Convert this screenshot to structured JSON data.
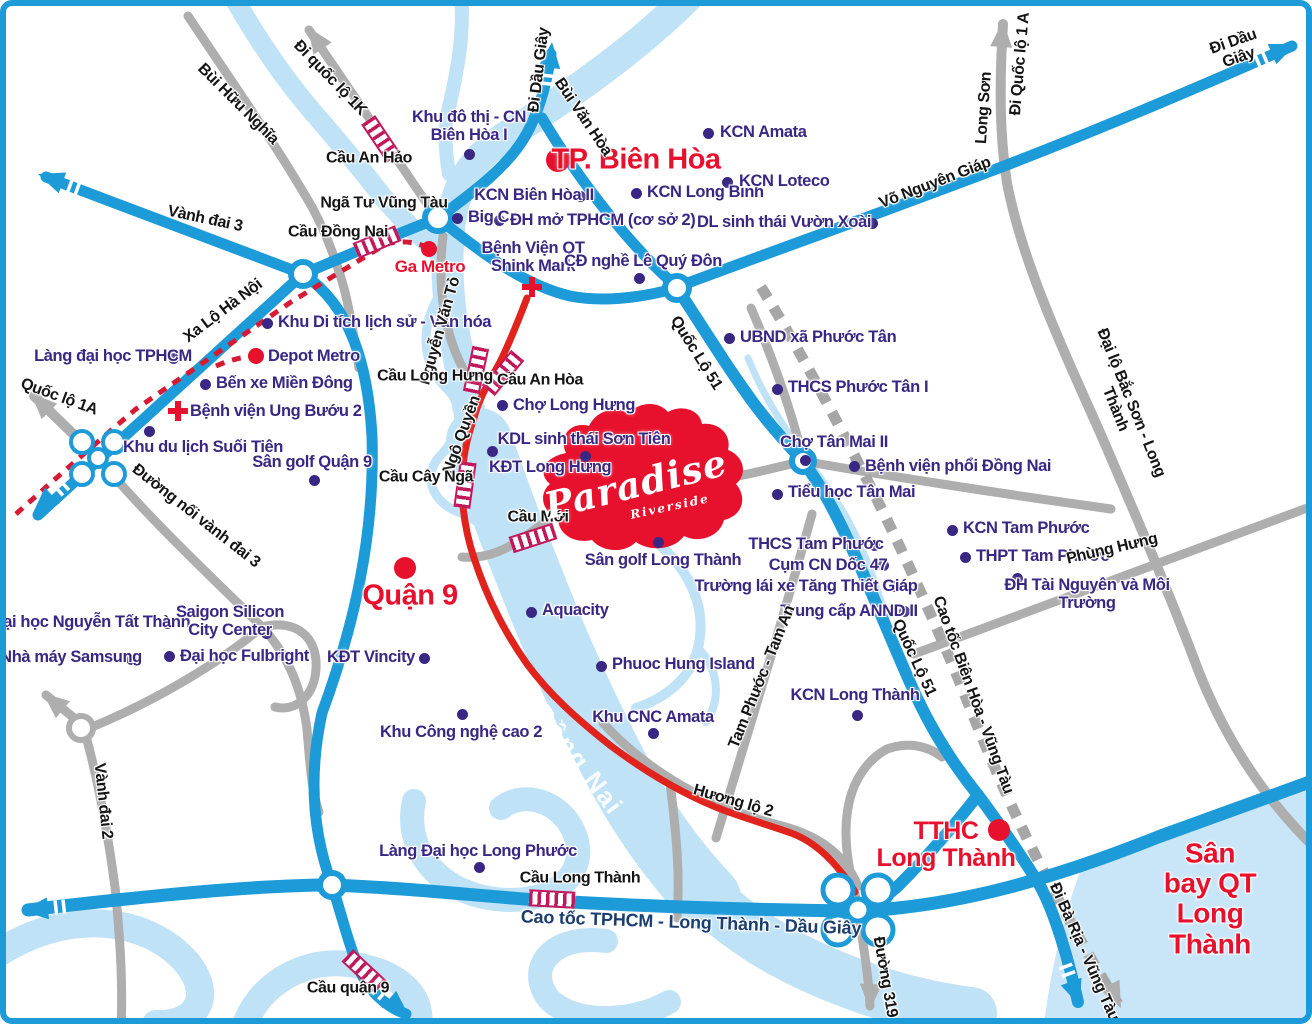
{
  "map_title": "Paradise Riverside area map (Biên Hòa - Long Thành)",
  "colors": {
    "road_blue": "#1C9BD8",
    "road_gray": "#AEAEAE",
    "road_red": "#E0231D",
    "river": "#BFE2F7",
    "airport_fill": "#C9E5F8",
    "poi_purple": "#3A2783",
    "label_red": "#E8112D",
    "bridge": "#C2185B",
    "metro_dash_red": "#D61A33",
    "expressway_dash_gray": "#A6A6A6",
    "highway_label_navy": "#1B3E70"
  },
  "logo": {
    "name": "Paradise",
    "sub": "Riverside"
  },
  "labels": [
    {
      "id": "khu-do-thi-cn-bien-hoa-1",
      "text": "Khu đô thị - CN\nBiên Hòa I",
      "x": 463,
      "y": 121,
      "cls": "lb-poi"
    },
    {
      "id": "kcn-amata",
      "text": "KCN Amata",
      "x": 714,
      "y": 127,
      "cls": "lb-poi",
      "align": "left"
    },
    {
      "id": "kcn-bien-hoa-2",
      "text": "KCN Biên Hòa II",
      "x": 528,
      "y": 190,
      "cls": "lb-poi"
    },
    {
      "id": "kcn-long-binh",
      "text": "KCN Long Bình",
      "x": 641,
      "y": 187,
      "cls": "lb-poi",
      "align": "left"
    },
    {
      "id": "kcn-loteco",
      "text": "KCN Loteco",
      "x": 733,
      "y": 176,
      "cls": "lb-poi",
      "align": "left"
    },
    {
      "id": "big-c",
      "text": "Big C",
      "x": 462,
      "y": 212,
      "cls": "lb-poi",
      "align": "left"
    },
    {
      "id": "dh-mo-tphcm",
      "text": "ĐH mở TPHCM (cơ sở 2)",
      "x": 504,
      "y": 215,
      "cls": "lb-poi",
      "align": "left"
    },
    {
      "id": "dl-sinh-thai-vuon-xoai",
      "text": "DL sinh thái Vườn Xoài",
      "x": 778,
      "y": 217,
      "cls": "lb-poi"
    },
    {
      "id": "benh-vien-qt-shink-mark",
      "text": "Bệnh Viện QT\nShink Mark",
      "x": 527,
      "y": 252,
      "cls": "lb-poi"
    },
    {
      "id": "cd-nghe-le-quy-don",
      "text": "CĐ nghề Lê Quý Đôn",
      "x": 637,
      "y": 256,
      "cls": "lb-poi"
    },
    {
      "id": "khu-di-tich-lich-su",
      "text": "Khu Di tích lịch sử - Văn hóa",
      "x": 272,
      "y": 317,
      "cls": "lb-poi",
      "align": "left"
    },
    {
      "id": "lang-dai-hoc-tphcm",
      "text": "Làng đại học TPHCM",
      "x": 107,
      "y": 351,
      "cls": "lb-poi"
    },
    {
      "id": "depot-metro",
      "text": "Depot Metro",
      "x": 262,
      "y": 351,
      "cls": "lb-poi",
      "align": "left"
    },
    {
      "id": "ben-xe-mien-dong",
      "text": "Bến xe Miền Đông",
      "x": 210,
      "y": 378,
      "cls": "lb-poi",
      "align": "left"
    },
    {
      "id": "benh-vien-ung-buou-2",
      "text": "Bệnh viện Ung Bướu 2",
      "x": 184,
      "y": 406,
      "cls": "lb-poi",
      "align": "left"
    },
    {
      "id": "khu-du-lich-suoi-tien",
      "text": "Khu du lịch Suối Tiên",
      "x": 197,
      "y": 442,
      "cls": "lb-poi"
    },
    {
      "id": "san-golf-quan-9",
      "text": "Sân golf Quận 9",
      "x": 306,
      "y": 457,
      "cls": "lb-poi"
    },
    {
      "id": "ubnd-xa-phuoc-tan",
      "text": "UBND xã Phước Tân",
      "x": 734,
      "y": 332,
      "cls": "lb-poi",
      "align": "left"
    },
    {
      "id": "thcs-phuoc-tan-1",
      "text": "THCS Phước Tân I",
      "x": 782,
      "y": 382,
      "cls": "lb-poi",
      "align": "left"
    },
    {
      "id": "cho-tan-mai-2",
      "text": "Chợ Tân Mai II",
      "x": 828,
      "y": 437,
      "cls": "lb-poi"
    },
    {
      "id": "benh-vien-phoi-dong-nai",
      "text": "Bệnh viện phổi Đồng Nai",
      "x": 859,
      "y": 461,
      "cls": "lb-poi",
      "align": "left"
    },
    {
      "id": "tieu-hoc-tan-mai",
      "text": "Tiểu học Tân Mai",
      "x": 782,
      "y": 487,
      "cls": "lb-poi",
      "align": "left"
    },
    {
      "id": "kcn-tam-phuoc",
      "text": "KCN Tam Phước",
      "x": 957,
      "y": 523,
      "cls": "lb-poi",
      "align": "left"
    },
    {
      "id": "thpt-tam-phuoc",
      "text": "THPT Tam Phước",
      "x": 970,
      "y": 551,
      "cls": "lb-poi",
      "align": "left"
    },
    {
      "id": "dh-tai-nguyen-moi-truong",
      "text": "ĐH Tài Nguyên và Môi Trường",
      "x": 1081,
      "y": 589,
      "cls": "lb-poi"
    },
    {
      "id": "thcs-tam-phuoc",
      "text": "THCS Tam Phước",
      "x": 810,
      "y": 539,
      "cls": "lb-poi"
    },
    {
      "id": "cum-cn-doc-47",
      "text": "Cụm CN Dốc  47",
      "x": 822,
      "y": 560,
      "cls": "lb-poi"
    },
    {
      "id": "truong-lai-xe-tang-thiet-giap",
      "text": "Trường lái xe Tăng Thiết Giáp",
      "x": 800,
      "y": 581,
      "cls": "lb-poi"
    },
    {
      "id": "trung-cap-annd-2",
      "text": "Trung cấp ANND II",
      "x": 843,
      "y": 606,
      "cls": "lb-poi"
    },
    {
      "id": "kcn-long-thanh",
      "text": "KCN Long Thành",
      "x": 849,
      "y": 690,
      "cls": "lb-poi"
    },
    {
      "id": "kdl-sinh-thai-son-tien",
      "text": "KDL sinh thái Sơn Tiên",
      "x": 578,
      "y": 434,
      "cls": "lb-poi"
    },
    {
      "id": "cho-long-hung",
      "text": "Chợ Long Hưng",
      "x": 507,
      "y": 400,
      "cls": "lb-poi",
      "align": "left"
    },
    {
      "id": "kdt-long-hung",
      "text": "KĐT Long Hưng",
      "x": 483,
      "y": 462,
      "cls": "lb-poi",
      "align": "left"
    },
    {
      "id": "san-golf-long-thanh",
      "text": "Sân golf Long Thành",
      "x": 657,
      "y": 555,
      "cls": "lb-poi"
    },
    {
      "id": "aquacity",
      "text": "Aquacity",
      "x": 536,
      "y": 605,
      "cls": "lb-poi",
      "align": "left"
    },
    {
      "id": "kdt-vincity",
      "text": "KĐT Vincity",
      "x": 365,
      "y": 652,
      "cls": "lb-poi"
    },
    {
      "id": "khu-cong-nghe-cao-2",
      "text": "Khu Công nghệ cao 2",
      "x": 455,
      "y": 727,
      "cls": "lb-poi"
    },
    {
      "id": "phuoc-hung-island",
      "text": "Phuoc Hung Island",
      "x": 606,
      "y": 659,
      "cls": "lb-poi",
      "align": "left"
    },
    {
      "id": "khu-cnc-amata",
      "text": "Khu CNC Amata",
      "x": 647,
      "y": 712,
      "cls": "lb-poi"
    },
    {
      "id": "dh-nguyen-tat-thanh",
      "text": "Đại học Nguyễn Tất Thành",
      "x": 85,
      "y": 617,
      "cls": "lb-poi"
    },
    {
      "id": "saigon-silicon-city-center",
      "text": "Saigon Silicon\nCity Center",
      "x": 224,
      "y": 616,
      "cls": "lb-poi"
    },
    {
      "id": "nha-may-samsung",
      "text": "Nhà máy Samsung",
      "x": 65,
      "y": 652,
      "cls": "lb-poi"
    },
    {
      "id": "dh-fulbright",
      "text": "Đại học Fulbright",
      "x": 174,
      "y": 651,
      "cls": "lb-poi",
      "align": "left"
    },
    {
      "id": "lang-dh-long-phuoc",
      "text": "Làng Đại học Long Phước",
      "x": 472,
      "y": 846,
      "cls": "lb-poi"
    },
    {
      "id": "tp-bien-hoa",
      "text": "TP. Biên Hòa",
      "x": 630,
      "y": 154,
      "cls": "lb-city"
    },
    {
      "id": "quan-9",
      "text": "Quận 9",
      "x": 404,
      "y": 590,
      "cls": "lb-city"
    },
    {
      "id": "tthc-long-thanh",
      "text": "TTHC\nLong Thành",
      "x": 940,
      "y": 839,
      "cls": "lb-city2"
    },
    {
      "id": "san-bay-qt-long-thanh",
      "text": "Sân bay QT\nLong Thành",
      "x": 1204,
      "y": 893,
      "cls": "lb-airport"
    },
    {
      "id": "ga-metro",
      "text": "Ga Metro",
      "x": 424,
      "y": 261,
      "cls": "lb-redsm"
    },
    {
      "id": "bui-huu-nghia",
      "text": "Bùi Hữu Nghĩa",
      "x": 232,
      "y": 98,
      "rot": 45,
      "cls": "lb-road"
    },
    {
      "id": "di-quoc-lo-1k",
      "text": "Đi quốc lộ 1K",
      "x": 324,
      "y": 72,
      "rot": 46,
      "cls": "lb-road"
    },
    {
      "id": "cau-an-hao",
      "text": "Cầu An Hảo",
      "x": 363,
      "y": 152,
      "cls": "lb-road"
    },
    {
      "id": "nga-tu-vung-tau",
      "text": "Ngã Tư Vũng Tàu",
      "x": 378,
      "y": 197,
      "cls": "lb-road"
    },
    {
      "id": "cau-dong-nai",
      "text": "Cầu Đồng Nai",
      "x": 332,
      "y": 226,
      "cls": "lb-road"
    },
    {
      "id": "vanh-dai-3",
      "text": "Vành đai 3",
      "x": 199,
      "y": 213,
      "rot": 12,
      "cls": "lb-road"
    },
    {
      "id": "xa-lo-ha-noi",
      "text": "Xa Lộ Hà Nội",
      "x": 217,
      "y": 305,
      "rot": -37,
      "cls": "lb-road"
    },
    {
      "id": "quoc-lo-1a",
      "text": "Quốc lộ 1A",
      "x": 53,
      "y": 391,
      "rot": 20,
      "cls": "lb-road"
    },
    {
      "id": "duong-noi-vanh-dai-3",
      "text": "Đường nối vành đai 3",
      "x": 190,
      "y": 510,
      "rot": 38,
      "cls": "lb-road"
    },
    {
      "id": "vanh-dai-2",
      "text": "Vành đai 2",
      "x": 97,
      "y": 795,
      "rot": 84,
      "cls": "lb-road"
    },
    {
      "id": "nguyen-van-to",
      "text": "Nguyễn Văn Tỏ",
      "x": 434,
      "y": 325,
      "rot": -74,
      "cls": "lb-road"
    },
    {
      "id": "ngo-quyen",
      "text": "Ngô Quyền",
      "x": 456,
      "y": 429,
      "rot": -70,
      "cls": "lb-road"
    },
    {
      "id": "bui-van-hoa",
      "text": "Bùi Văn Hòa",
      "x": 577,
      "y": 111,
      "rot": 56,
      "cls": "lb-road"
    },
    {
      "id": "vo-nguyen-giap",
      "text": "Võ Nguyên Giáp",
      "x": 929,
      "y": 177,
      "rot": -21,
      "cls": "lb-road"
    },
    {
      "id": "long-son",
      "text": "Long Sơn",
      "x": 978,
      "y": 102,
      "rot": -86,
      "cls": "lb-road"
    },
    {
      "id": "di-quoc-lo-1a",
      "text": "Đi Quốc lộ 1 A",
      "x": 1014,
      "y": 58,
      "rot": -85,
      "cls": "lb-road"
    },
    {
      "id": "di-dau-giay-right",
      "text": "Đi Dầu Giây",
      "x": 1230,
      "y": 44,
      "rot": -19,
      "cls": "lb-road"
    },
    {
      "id": "di-dau-giay-top",
      "text": "Đi Dầu Giây",
      "x": 533,
      "y": 64,
      "rot": -83,
      "cls": "lb-road"
    },
    {
      "id": "quoc-lo-51-upper",
      "text": "Quốc Lộ 51",
      "x": 690,
      "y": 347,
      "rot": 58,
      "cls": "lb-road"
    },
    {
      "id": "quoc-lo-51-lower",
      "text": "Quốc Lộ 51",
      "x": 908,
      "y": 652,
      "rot": 65,
      "cls": "lb-road"
    },
    {
      "id": "dai-lo-bac-son-long-thanh",
      "text": "Đại lộ Bắc Sơn - Long Thành",
      "x": 1117,
      "y": 400,
      "rot": 68,
      "cls": "lb-road"
    },
    {
      "id": "phung-hung",
      "text": "Phùng Hưng",
      "x": 1106,
      "y": 543,
      "rot": -13,
      "cls": "lb-road"
    },
    {
      "id": "tam-phuoc-tam-an",
      "text": "Tam Phước - Tam An",
      "x": 756,
      "y": 671,
      "rot": -68,
      "cls": "lb-road"
    },
    {
      "id": "cao-toc-bien-hoa-vung-tau",
      "text": "Cao tốc Biên Hòa - Vũng Tàu",
      "x": 967,
      "y": 689,
      "rot": 70,
      "cls": "lb-road"
    },
    {
      "id": "huong-lo-2",
      "text": "Hương lộ 2",
      "x": 727,
      "y": 795,
      "rot": 16,
      "cls": "lb-road"
    },
    {
      "id": "cau-moi",
      "text": "Cầu Mới",
      "x": 532,
      "y": 511,
      "cls": "lb-road"
    },
    {
      "id": "cau-long-hung",
      "text": "Cầu Long Hưng",
      "x": 429,
      "y": 370,
      "cls": "lb-road"
    },
    {
      "id": "cau-an-hoa",
      "text": "Cầu An Hòa",
      "x": 534,
      "y": 374,
      "cls": "lb-road"
    },
    {
      "id": "cau-cay-nga",
      "text": "Cầu Cây Ngã",
      "x": 420,
      "y": 471,
      "cls": "lb-road"
    },
    {
      "id": "cau-long-thanh",
      "text": "Cầu Long Thành",
      "x": 574,
      "y": 872,
      "cls": "lb-road"
    },
    {
      "id": "cau-quan-9",
      "text": "Cầu quận 9",
      "x": 342,
      "y": 982,
      "cls": "lb-road"
    },
    {
      "id": "duong-319",
      "text": "Đường 319",
      "x": 879,
      "y": 971,
      "rot": 80,
      "cls": "lb-road"
    },
    {
      "id": "di-ba-ria-vung-tau",
      "text": "Đi Bà Rịa - Vũng Tàu",
      "x": 1078,
      "y": 946,
      "rot": 66,
      "cls": "lb-road"
    },
    {
      "id": "cao-toc-tphcm-long-thanh-dau-giay",
      "text": "Cao tốc TPHCM - Long Thành - Dầu Giây",
      "x": 685,
      "y": 917,
      "rot": 2,
      "cls": "lb-hwy"
    },
    {
      "id": "song-dong-nai",
      "text": "Sông Đồng Nai",
      "x": 548,
      "y": 721,
      "rot": 53,
      "cls": "lb-river"
    },
    {
      "id": "paradise-logo",
      "text": "Paradise",
      "x": 630,
      "y": 479,
      "rot": -14,
      "cls": "lb-paradise"
    },
    {
      "id": "paradise-riverside",
      "text": "Riverside",
      "x": 664,
      "y": 501,
      "rot": -12,
      "cls": "lb-paradise-sub"
    }
  ],
  "markers": [
    {
      "id": "dot-khu-do-thi-bien-hoa-1",
      "type": "dot-purple",
      "x": 463,
      "y": 148,
      "r": 5.5
    },
    {
      "id": "dot-kcn-amata",
      "type": "dot-purple",
      "x": 702,
      "y": 127,
      "r": 5.5
    },
    {
      "id": "dot-kcn-bien-hoa-2",
      "type": "dot-purple",
      "x": 574,
      "y": 190,
      "r": 5.5
    },
    {
      "id": "dot-kcn-long-binh",
      "type": "dot-purple",
      "x": 630,
      "y": 187,
      "r": 5.5
    },
    {
      "id": "dot-kcn-loteco",
      "type": "dot-purple",
      "x": 721,
      "y": 176,
      "r": 5.5
    },
    {
      "id": "dot-big-c",
      "type": "dot-purple",
      "x": 451,
      "y": 212,
      "r": 5.5
    },
    {
      "id": "dot-dh-mo-tphcm",
      "type": "dot-purple",
      "x": 493,
      "y": 214,
      "r": 5.5
    },
    {
      "id": "dot-vuon-xoai",
      "type": "dot-purple",
      "x": 866,
      "y": 217,
      "r": 5.5
    },
    {
      "id": "dot-le-quy-don",
      "type": "dot-purple",
      "x": 633,
      "y": 272,
      "r": 5.5
    },
    {
      "id": "dot-khu-di-tich",
      "type": "dot-purple",
      "x": 261,
      "y": 317,
      "r": 5.5
    },
    {
      "id": "dot-lang-dh-tphcm",
      "type": "dot-purple",
      "x": 167,
      "y": 352,
      "r": 5.5
    },
    {
      "id": "dot-ben-xe-mien-dong",
      "type": "dot-purple",
      "x": 199,
      "y": 378,
      "r": 5.5
    },
    {
      "id": "dot-suoi-tien",
      "type": "dot-purple",
      "x": 143,
      "y": 425,
      "r": 5.5
    },
    {
      "id": "dot-san-golf-quan-9",
      "type": "dot-purple",
      "x": 308,
      "y": 474,
      "r": 5.5
    },
    {
      "id": "dot-ubnd-phuoc-tan",
      "type": "dot-purple",
      "x": 723,
      "y": 332,
      "r": 5.5
    },
    {
      "id": "dot-thcs-phuoc-tan",
      "type": "dot-purple",
      "x": 771,
      "y": 383,
      "r": 5.5
    },
    {
      "id": "dot-cho-tan-mai",
      "type": "dot-purple",
      "x": 799,
      "y": 454,
      "r": 5.5
    },
    {
      "id": "dot-bv-phoi",
      "type": "dot-purple",
      "x": 848,
      "y": 460,
      "r": 5.5
    },
    {
      "id": "dot-tieu-hoc-tan-mai",
      "type": "dot-purple",
      "x": 771,
      "y": 488,
      "r": 5.5
    },
    {
      "id": "dot-kcn-tam-phuoc",
      "type": "dot-purple",
      "x": 946,
      "y": 524,
      "r": 5.5
    },
    {
      "id": "dot-thpt-tam-phuoc",
      "type": "dot-purple",
      "x": 959,
      "y": 551,
      "r": 5.5
    },
    {
      "id": "dot-dh-tai-nguyen",
      "type": "dot-purple",
      "x": 1011,
      "y": 572,
      "r": 5.5
    },
    {
      "id": "dot-thcs-tam-phuoc",
      "type": "dot-purple",
      "x": 868,
      "y": 539,
      "r": 5.5
    },
    {
      "id": "dot-cum-cn-doc-47",
      "type": "dot-purple",
      "x": 877,
      "y": 559,
      "r": 5.5
    },
    {
      "id": "dot-truong-lai-xe",
      "type": "dot-purple",
      "x": 888,
      "y": 580,
      "r": 5.5
    },
    {
      "id": "dot-trung-cap-annd",
      "type": "dot-purple",
      "x": 898,
      "y": 605,
      "r": 5.5
    },
    {
      "id": "dot-kcn-long-thanh",
      "type": "dot-purple",
      "x": 851,
      "y": 709,
      "r": 5.5
    },
    {
      "id": "dot-son-tien",
      "type": "dot-purple",
      "x": 579,
      "y": 450,
      "r": 5.5
    },
    {
      "id": "dot-cho-long-hung",
      "type": "dot-purple",
      "x": 496,
      "y": 399,
      "r": 5.5
    },
    {
      "id": "dot-kdt-long-hung",
      "type": "dot-purple",
      "x": 486,
      "y": 445,
      "r": 5.5
    },
    {
      "id": "dot-san-golf-long-thanh",
      "type": "dot-purple",
      "x": 652,
      "y": 536,
      "r": 5.5
    },
    {
      "id": "dot-aquacity",
      "type": "dot-purple",
      "x": 525,
      "y": 606,
      "r": 5.5
    },
    {
      "id": "dot-kdt-vincity",
      "type": "dot-purple",
      "x": 418,
      "y": 652,
      "r": 5.5
    },
    {
      "id": "dot-khu-cong-nghe-cao-2",
      "type": "dot-purple",
      "x": 456,
      "y": 708,
      "r": 5.5
    },
    {
      "id": "dot-phuoc-hung-island",
      "type": "dot-purple",
      "x": 595,
      "y": 660,
      "r": 5.5
    },
    {
      "id": "dot-khu-cnc-amata",
      "type": "dot-purple",
      "x": 647,
      "y": 727,
      "r": 5.5
    },
    {
      "id": "dot-dh-nguyen-tat-thanh",
      "type": "dot-purple",
      "x": 161,
      "y": 617,
      "r": 5.5
    },
    {
      "id": "dot-saigon-silicon",
      "type": "dot-purple",
      "x": 260,
      "y": 627,
      "r": 5.5
    },
    {
      "id": "dot-samsung",
      "type": "dot-purple",
      "x": 125,
      "y": 653,
      "r": 5.5
    },
    {
      "id": "dot-fulbright",
      "type": "dot-purple",
      "x": 163,
      "y": 650,
      "r": 5.5
    },
    {
      "id": "dot-lang-dh-long-phuoc",
      "type": "dot-purple",
      "x": 473,
      "y": 861,
      "r": 5.5
    },
    {
      "id": "dot-tp-bien-hoa",
      "type": "dot-red",
      "x": 552,
      "y": 154,
      "r": 12
    },
    {
      "id": "dot-quan-9",
      "type": "dot-red",
      "x": 399,
      "y": 562,
      "r": 11
    },
    {
      "id": "dot-tthc-long-thanh",
      "type": "dot-red",
      "x": 993,
      "y": 824,
      "r": 11
    },
    {
      "id": "dot-ga-metro",
      "type": "dot-red",
      "x": 423,
      "y": 243,
      "r": 8
    },
    {
      "id": "dot-depot-metro",
      "type": "dot-red",
      "x": 250,
      "y": 350,
      "r": 8
    },
    {
      "id": "cross-shink-mark",
      "type": "cross",
      "x": 526,
      "y": 281
    },
    {
      "id": "cross-ung-buou-2",
      "type": "cross",
      "x": 172,
      "y": 405
    }
  ],
  "bridges": [
    {
      "id": "bridge-cau-an-hao",
      "x": 375,
      "y": 133,
      "rot": 56
    },
    {
      "id": "bridge-cau-dong-nai",
      "x": 371,
      "y": 236,
      "rot": -23
    },
    {
      "id": "bridge-cau-long-hung",
      "x": 470,
      "y": 364,
      "rot": -78
    },
    {
      "id": "bridge-cau-an-hoa",
      "x": 497,
      "y": 367,
      "rot": -50
    },
    {
      "id": "bridge-cau-cay-nga",
      "x": 459,
      "y": 479,
      "rot": -82
    },
    {
      "id": "bridge-cau-moi",
      "x": 527,
      "y": 532,
      "rot": -18
    },
    {
      "id": "bridge-cau-long-thanh",
      "x": 546,
      "y": 893,
      "rot": 3
    },
    {
      "id": "bridge-cau-quan-9",
      "x": 358,
      "y": 965,
      "rot": 43
    }
  ]
}
